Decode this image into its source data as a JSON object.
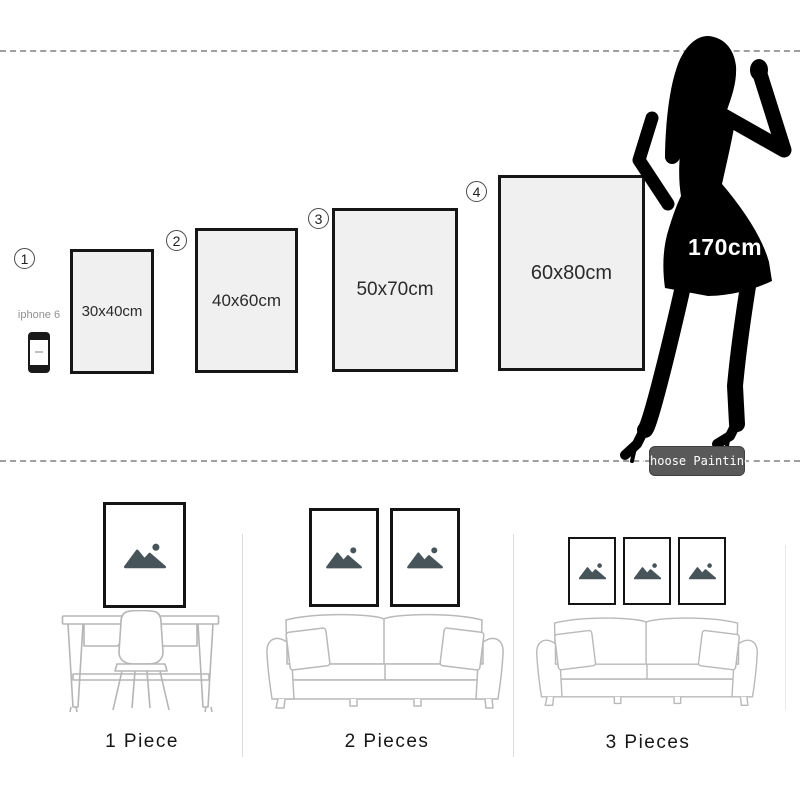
{
  "size_chart": {
    "items": [
      {
        "number": "1",
        "size_label": "30x40cm"
      },
      {
        "number": "2",
        "size_label": "40x60cm"
      },
      {
        "number": "3",
        "size_label": "50x70cm"
      },
      {
        "number": "4",
        "size_label": "60x80cm"
      }
    ],
    "reference_phone": {
      "label": "iphone 6"
    },
    "reference_person": {
      "height_label": "170cm"
    },
    "button_label": "Choose Painting"
  },
  "arrangements": [
    {
      "label": "1 Piece",
      "frame_count": 1
    },
    {
      "label": "2 Pieces",
      "frame_count": 2
    },
    {
      "label": "3 Pieces",
      "frame_count": 3
    }
  ],
  "colors": {
    "frame_fill": "#f0f0f0",
    "frame_border": "#161616",
    "silhouette": "#000000",
    "button_bg": "#595959",
    "furniture_stroke": "#b9b9b9",
    "placeholder_icon": "#47545a",
    "dash_line": "#9f9f9f",
    "divider": "#dcdcdc"
  }
}
